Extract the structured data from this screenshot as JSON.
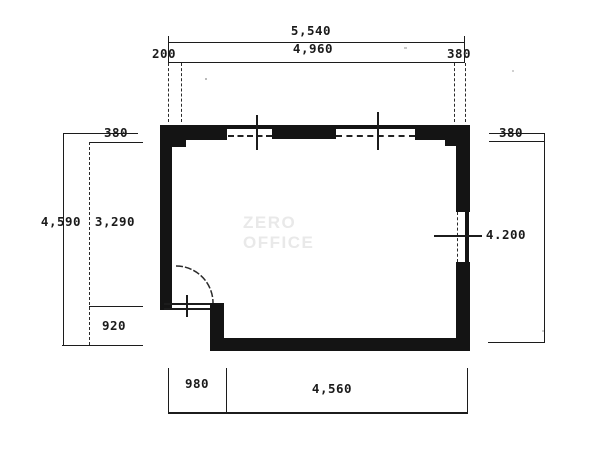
{
  "watermark": "ZERO OFFICE",
  "dims": {
    "top": {
      "overall": "5,540",
      "seg_left": "200",
      "seg_mid": "4,960",
      "seg_right": "380"
    },
    "left": {
      "overall": "4,590",
      "seg_top": "380",
      "seg_mid": "3,290",
      "seg_bottom": "920"
    },
    "right": {
      "seg_top": "380",
      "seg_main": "4.200"
    },
    "bottom": {
      "seg_left": "980",
      "seg_right": "4,560"
    }
  },
  "colors": {
    "line": "#1c1c1c",
    "wall": "#141414",
    "watermark": "#e9e9e9",
    "background": "#ffffff"
  }
}
